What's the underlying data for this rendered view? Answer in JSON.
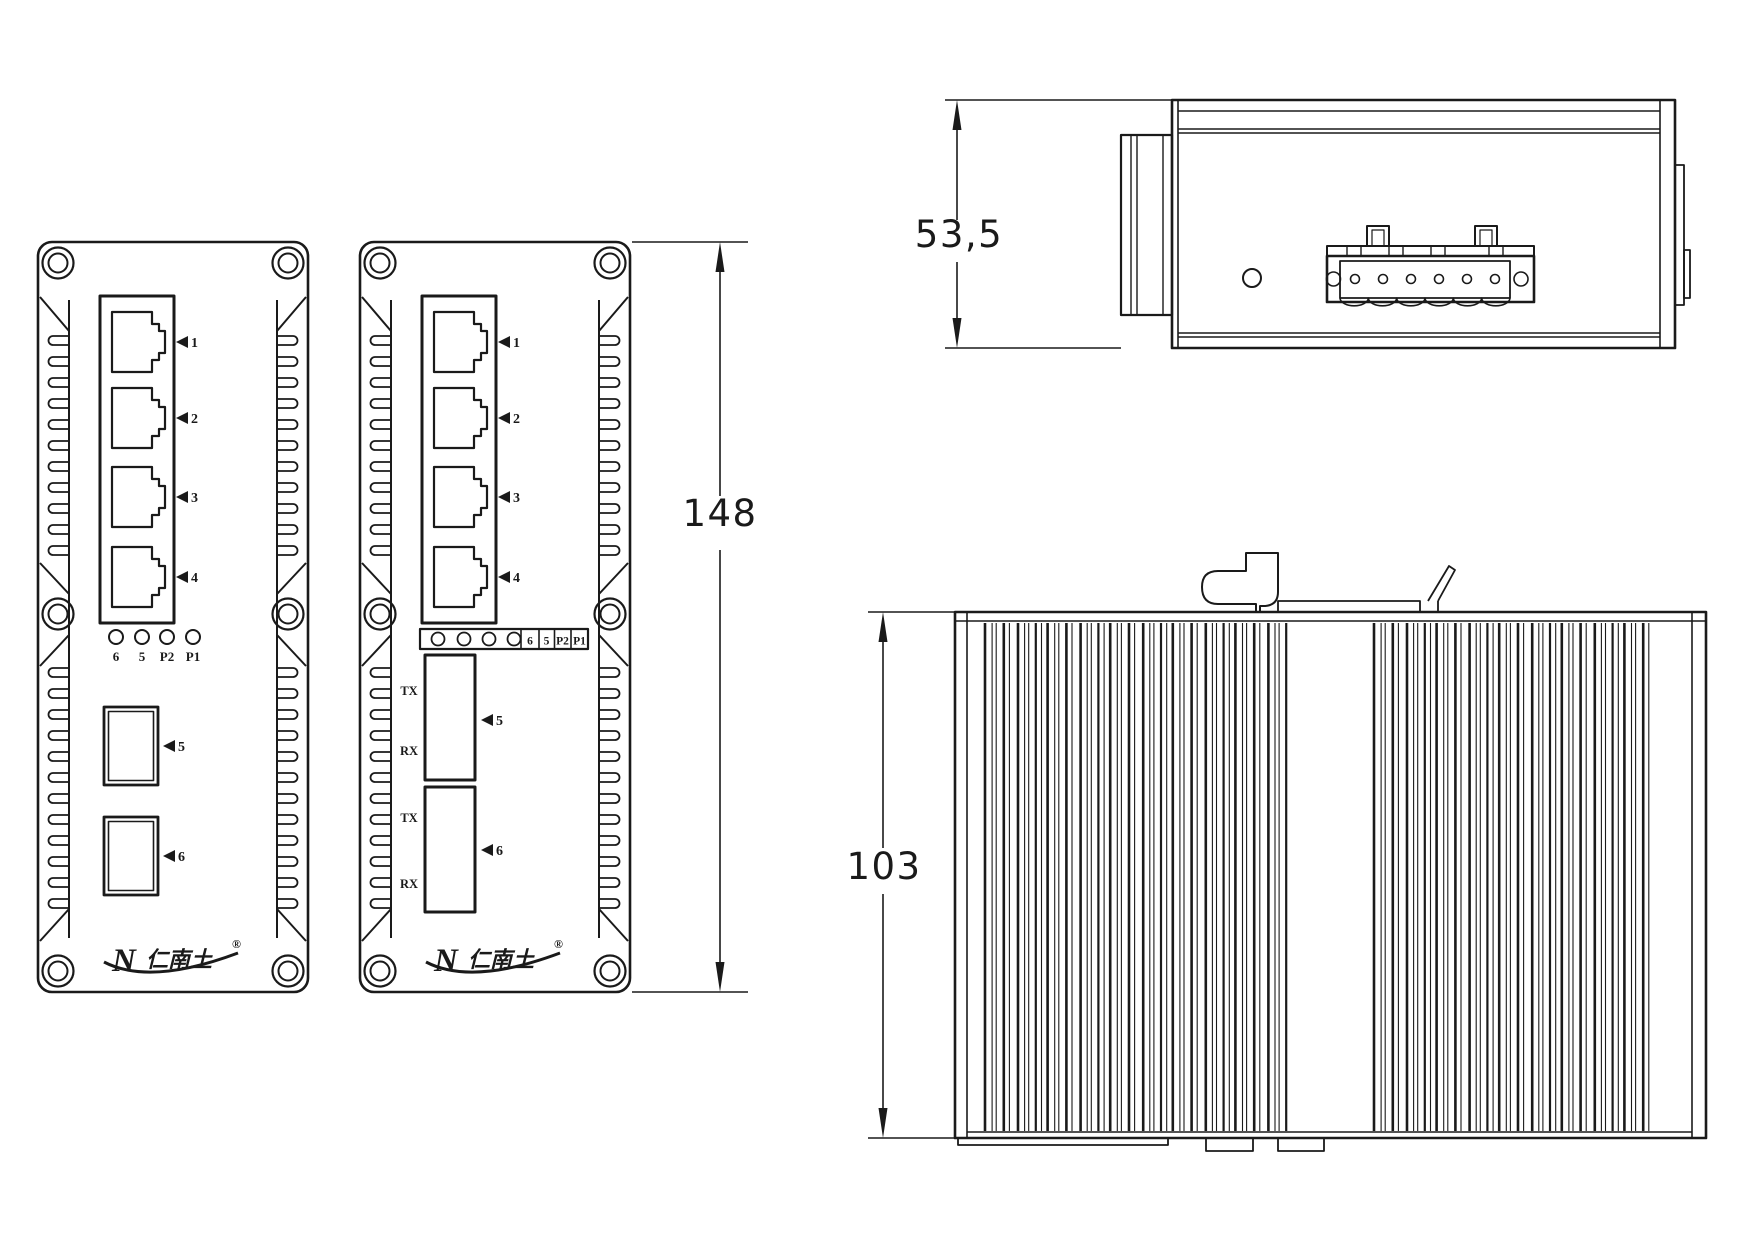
{
  "title": "Industrial Ethernet switch dimensional drawing",
  "colors": {
    "ink": "#1a1a1a",
    "paper": "#ffffff"
  },
  "dimensions": {
    "front_height": "148",
    "top_depth": "53,5",
    "side_height": "103"
  },
  "front_panel": {
    "rj45_labels": [
      "1",
      "2",
      "3",
      "4"
    ],
    "sfp_labels": [
      "5",
      "6"
    ],
    "led_labels": [
      "6",
      "5",
      "P2",
      "P1"
    ],
    "fiber_labels": [
      "TX",
      "RX",
      "TX",
      "RX"
    ],
    "logo_n": "N",
    "logo_cjk": "仁南土",
    "logo_reg": "®"
  }
}
